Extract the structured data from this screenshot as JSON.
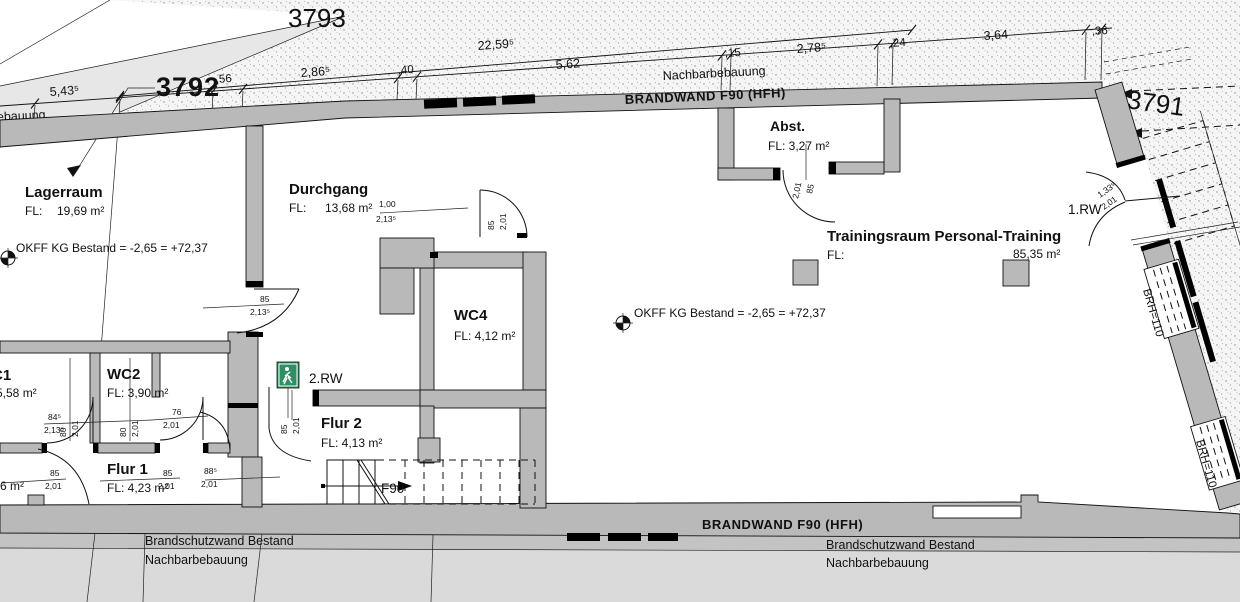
{
  "title": "Grundriss Brandschutzplan (Bestand)",
  "parcels": {
    "p3793": "3793",
    "p3792": "3792",
    "p3791": "3791"
  },
  "dimensions": {
    "overall": "22,59⁵",
    "chain": [
      "5,43⁵",
      ",56",
      "2,86⁵",
      ",40",
      "5,62",
      ",15",
      "2,78⁵",
      ",24",
      "3,64",
      ",36"
    ]
  },
  "labels": {
    "brandwand_top": "BRANDWAND F90 (HFH)",
    "brandwand_bottom": "BRANDWAND F90 (HFH)",
    "nachbarbebauung_top": "Nachbarbebauung",
    "nachbarbebauung_left": "Nachbarbebauung",
    "brandschutzwand_left": "Brandschutzwand Bestand",
    "nachbarbebauung_bottom_left": "Nachbarbebauung",
    "brandschutzwand_right": "Brandschutzwand Bestand",
    "nachbarbebauung_bottom_right": "Nachbarbebauung",
    "okff_1": "OKFF KG Bestand = -2,65 = +72,37",
    "okff_2": "OKFF KG Bestand = -2,65 = +72,37",
    "rw1": "1.RW",
    "rw2": "2.RW",
    "f90_stairs": "F90",
    "brh_1": "BRH=110",
    "brh_2": "BRH=110"
  },
  "rooms": {
    "lagerraum": {
      "name": "Lagerraum",
      "fl": "FL:",
      "area": "19,69 m²"
    },
    "durchgang": {
      "name": "Durchgang",
      "fl": "FL:",
      "area": "13,68 m²"
    },
    "abst": {
      "name": "Abst.",
      "area": "FL: 3,27 m²"
    },
    "training": {
      "name": "Trainingsraum Personal-Training",
      "fl": "FL:",
      "area": "85,35 m²"
    },
    "wc4": {
      "name": "WC4",
      "area": "FL: 4,12 m²"
    },
    "wc2": {
      "name": "WC2",
      "area": "FL: 3,90 m²"
    },
    "wc1": {
      "name": "C1",
      "area": "5,58 m²"
    },
    "flur1": {
      "name": "Flur 1",
      "area": "FL: 4,23 m²"
    },
    "flur2": {
      "name": "Flur 2",
      "area": "FL: 4,13 m²"
    },
    "left_room": {
      "area": "6 m²"
    }
  },
  "door_dims": {
    "lager": {
      "w": "85",
      "h": "2,13⁵"
    },
    "durchgang": {
      "w": "1,00",
      "h": "2,13⁵"
    },
    "wc4": {
      "w": "85",
      "h": "2,01"
    },
    "abst": {
      "w": "85",
      "h": "2,01"
    },
    "rw2": {
      "w": "85",
      "h": "2,01"
    },
    "wc1": {
      "w": "84⁵",
      "h": "2,13⁵"
    },
    "wc2": {
      "w": "76",
      "h": "2,01"
    },
    "pos1": {
      "w": "80",
      "h": "2,01"
    },
    "pos2": {
      "w": "80",
      "h": "2,01"
    },
    "b1": {
      "w": "85",
      "h": "2,01"
    },
    "b2": {
      "w": "85",
      "h": "2,01"
    },
    "b3": {
      "w": "88⁵",
      "h": "2,01"
    },
    "rw1": {
      "w": "1,33⁵",
      "h": "2,01"
    }
  },
  "icons": {
    "exit_sign": "running-man-exit-pictogram",
    "survey_marker": "benchmark-cross-circle"
  },
  "colors": {
    "wall": "#b9b9b9",
    "neighbor_band": "#c3c3c3",
    "neighbor_area": "#dadada",
    "parcel_light": "#e7e7e7",
    "exit_green": "#2f8f63"
  }
}
